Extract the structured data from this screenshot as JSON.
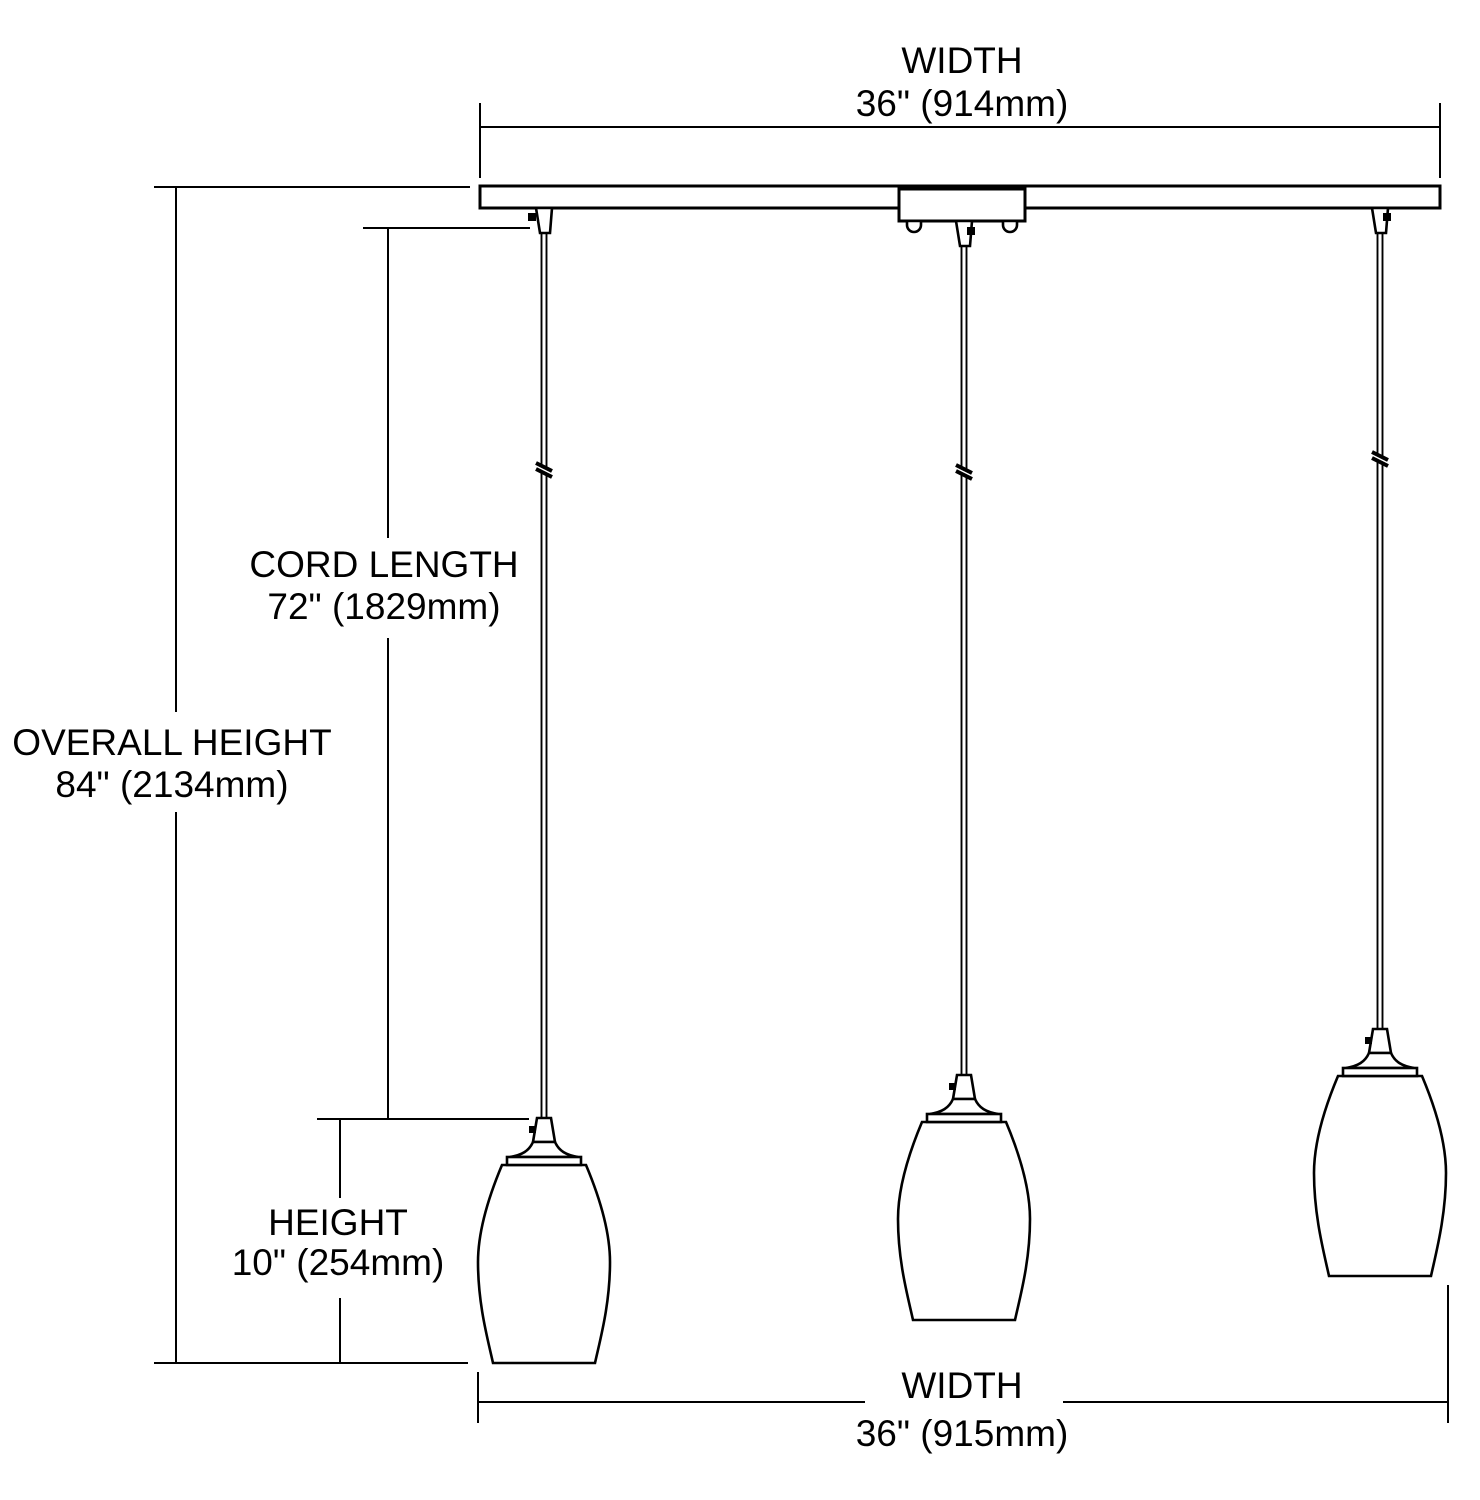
{
  "diagram": {
    "kind": "dimension-line-drawing",
    "subject": "three-light linear pendant fixture",
    "colors": {
      "line": "#000000",
      "background": "#ffffff",
      "text": "#000000"
    },
    "dimensions": {
      "top_width": {
        "label": "WIDTH",
        "value": "36\" (914mm)"
      },
      "overall_height": {
        "label": "OVERALL HEIGHT",
        "value": "84\" (2134mm)"
      },
      "cord_length": {
        "label": "CORD LENGTH",
        "value": "72\" (1829mm)"
      },
      "shade_height": {
        "label": "HEIGHT",
        "value": "10\" (254mm)"
      },
      "bottom_width": {
        "label": "WIDTH",
        "value": "36\" (915mm)"
      }
    }
  }
}
